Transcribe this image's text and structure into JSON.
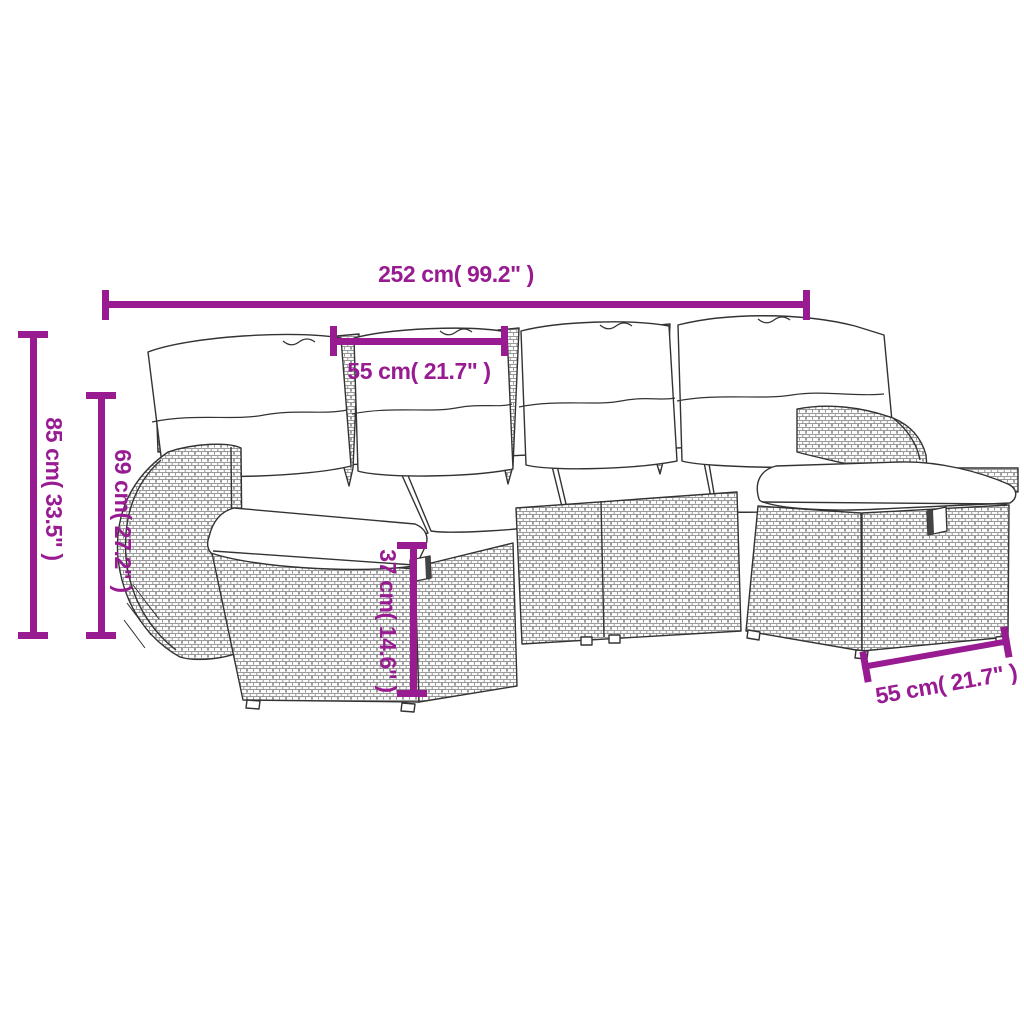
{
  "colors": {
    "dimension_accent": "#981b92",
    "drawing_outline": "#333333",
    "weave_line": "#8d8d8d",
    "background": "#ffffff"
  },
  "dimensions": {
    "overall_width": {
      "label": "252 cm( 99.2\" )"
    },
    "seat_width": {
      "label": "55 cm( 21.7\" )"
    },
    "overall_height": {
      "label": "85 cm( 33.5\" )"
    },
    "armrest_height": {
      "label": "69 cm( 27.2\" )"
    },
    "ottoman_height": {
      "label": "37 cm( 14.6\" )"
    },
    "ottoman_width": {
      "label": "55 cm( 21.7\" )"
    }
  }
}
